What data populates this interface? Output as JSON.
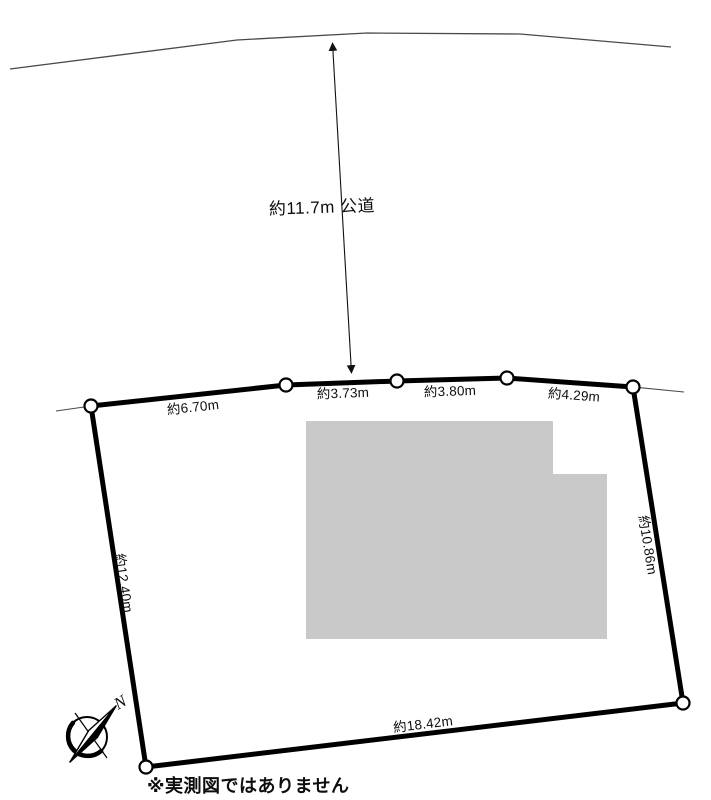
{
  "diagram": {
    "road_label": "約11.7m 公道",
    "edge_labels": {
      "top": [
        "約6.70m",
        "約3.73m",
        "約3.80m",
        "約4.29m"
      ],
      "left": "約12.40m",
      "right": "約10.86m",
      "bottom": "約18.42m"
    },
    "compass_north": "N",
    "note": "※実測図ではありません"
  },
  "colors": {
    "boundary": "#000000",
    "road_line": "#4a4a4a",
    "building_fill": "#c9c9c9",
    "background": "#ffffff"
  }
}
